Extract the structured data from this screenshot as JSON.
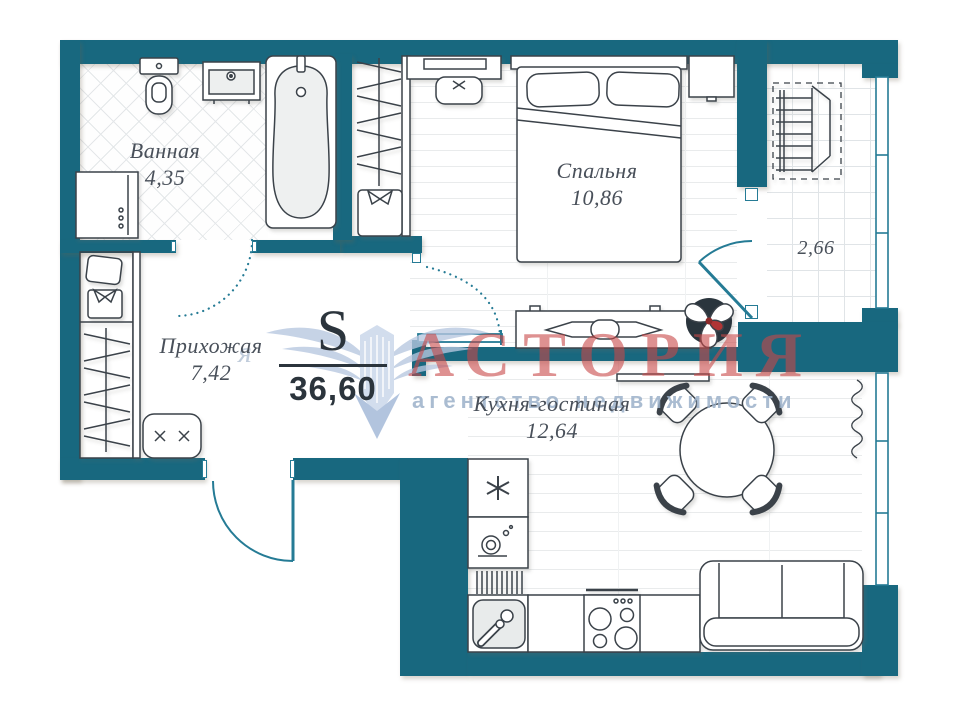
{
  "plan": {
    "total": {
      "symbol": "S",
      "value": "36,60"
    },
    "rooms": {
      "bathroom": {
        "name": "Ванная",
        "area": "4,35"
      },
      "bedroom": {
        "name": "Спальня",
        "area": "10,86"
      },
      "hallway": {
        "name": "Прихожая",
        "area": "7,42"
      },
      "kitchen_living": {
        "name": "Кухня-гостиная",
        "area": "12,64"
      },
      "balcony": {
        "area": "2,66"
      }
    },
    "watermark": {
      "title": "АСТОРИЯ",
      "subtitle": "агентство недвижимости",
      "fragment": "я"
    },
    "colors": {
      "wall": "#18687f",
      "door_accent": "#257b95",
      "watermark_title": "#c85050",
      "watermark_subtitle": "#9bb0c9",
      "label_text": "#49505a"
    }
  }
}
